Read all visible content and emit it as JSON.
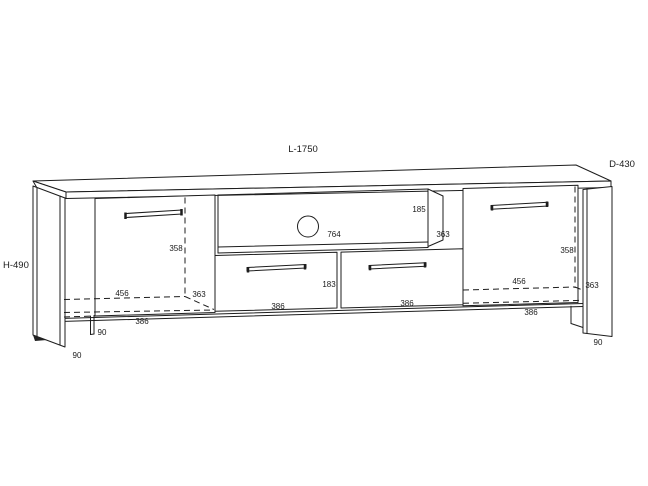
{
  "drawing": {
    "type": "furniture-technical-drawing",
    "subject": "tv-stand-cabinet",
    "background": "#ffffff",
    "line_color": "#1d1d1d",
    "overall": {
      "length_label": "L-1750",
      "depth_label": "D-430",
      "height_label": "H-490"
    },
    "dims": {
      "shelf_opening_height": "185",
      "shelf_opening_width": "764",
      "shelf_depth": "363",
      "left_door_height": "358",
      "right_door_height": "358",
      "left_door_width": "456",
      "right_door_width": "456",
      "left_door_swing_depth": "363",
      "right_door_swing_depth": "363",
      "left_door_opening_width": "386",
      "right_door_opening_width": "386",
      "left_drawer_width": "386",
      "right_drawer_width": "386",
      "drawer_front_height": "183",
      "front_left_leg_height": "90",
      "left_panel_leg_height": "90",
      "right_panel_leg_height": "90"
    }
  }
}
